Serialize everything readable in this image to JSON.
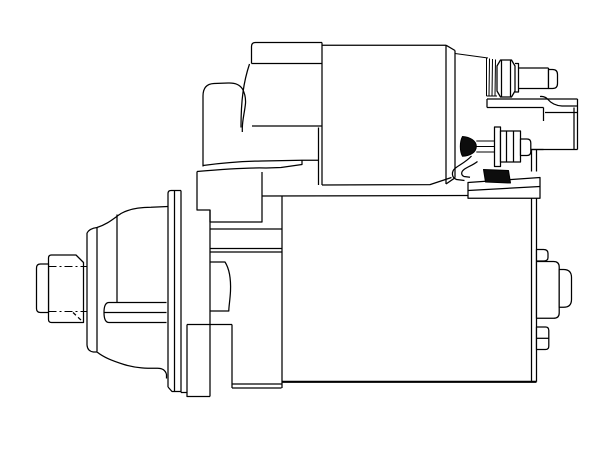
{
  "meta": {
    "description": "Technical side-view line drawing of an automotive starter motor with solenoid, terminal studs, mounting flange and splined drive shaft",
    "background_color": "#ffffff",
    "line_color": "#000000"
  },
  "illustration": {
    "width": 612,
    "height": 459,
    "viewBox": "0 0 612 459",
    "stroke": "#000000",
    "strokeWidth": 1.25,
    "shapes": [
      {
        "name": "spline-collar",
        "fill": "#ffffff",
        "d": "M51.5,255 L76,255 L83.5,262.5 L83.5,322.5 L51.5,322.5 Q48.5,322.5 48.5,319.5 L48.5,258 Q48.5,255 51.5,255 Z"
      },
      {
        "name": "spline-collar-chamfer-hidden",
        "dash": "4 3",
        "d": "M73,312.5 L83.5,322.5"
      },
      {
        "name": "spline-centerline-top",
        "dash": "8 3 2 3",
        "sw": 1.0,
        "d": "M48.5,266.5 L86.5,266.5"
      },
      {
        "name": "spline-centerline-bottom",
        "dash": "8 3 2 3",
        "sw": 1.0,
        "d": "M48.5,311.5 L86.5,311.5"
      },
      {
        "name": "drive-shaft-nose",
        "fill": "#ffffff",
        "d": "M48.5,264 L40.5,264 Q36.5,264 36.5,268 L36.5,308.5 Q36.5,312.5 40.5,312.5 L48.5,312.5 Z"
      },
      {
        "name": "drive-housing-top-contour",
        "d": "M87,233 Q89.5,228.5 97,227.5 C108,224 113.5,218.5 121,213.5 C129,209 139.5,207.3 151,207.3 L168,206.5"
      },
      {
        "name": "drive-housing-front-rim",
        "d": "M87,233 L87,345 M97,227.5 L97,351.5 M87,345 Q87.5,351.3 93.5,352 L97,352"
      },
      {
        "name": "drive-housing-bottom-contour",
        "d": "M97,352 C104,357.5 111.5,360.5 124,364.5 C137,368.5 149,368.3 157.5,368.3 C163,368.3 165.5,370.5 166.5,374.5 L166.5,378.5"
      },
      {
        "name": "drive-housing-step-line",
        "d": "M117,214.5 L117,302"
      },
      {
        "name": "drive-housing-slot",
        "d": "M166.5,302.5 L109,302.5 Q104,302.5 104,312.5 Q104,322.5 109,322.5 L166.5,322.5 M104.3,312.5 L166.5,312.5"
      },
      {
        "name": "mounting-flange",
        "d": "M168,387 L168,193.5 Q168,190.5 171,190.5 L181,190.5 M174.5,190.5 L174.5,391.5 M181,190.5 L181,392.5 M168,387 L172,391.5 L181,391.5 M181,392.5 L187,392.5"
      },
      {
        "name": "gear-housing-block",
        "d": "M197,171.5 L197,210 L210,210 L210,222 L262,222 L262,172"
      },
      {
        "name": "front-bracket-hump",
        "d": "M203,166.5 L203,96 Q203,84 214,83.5 L228,83 Q238.5,82.5 242.5,89 Q246,95.5 245.5,103.5 C244.5,113 242.5,119 242.3,128 L242.3,132"
      },
      {
        "name": "solenoid-hidden-edge-arc",
        "d": "M249.5,64 C243.5,82 241,100 241,127.5"
      },
      {
        "name": "bracket-edge-upper",
        "d": "M203,165.5 C225,162.5 245,161.2 262,161 L302,160.3 L318.5,160.3"
      },
      {
        "name": "bracket-edge-lower",
        "d": "M197,171.5 C225,169 249,167.5 266,168 L281,167.5 L302,164.5 L302,160.3"
      },
      {
        "name": "yoke-band-top",
        "d": "M210,229 L282,229"
      },
      {
        "name": "yoke-band-mid",
        "d": "M210,248.5 L282,248.5"
      },
      {
        "name": "yoke-band-bottom",
        "d": "M210,252 L282,252"
      },
      {
        "name": "yoke-left-edge",
        "d": "M210,210 L210,396.5"
      },
      {
        "name": "pinion-guide-block",
        "d": "M210,262 L225,262 C229.5,269 231,278 230.5,291 C230,301 228.8,306 228.8,311 L210,311"
      },
      {
        "name": "lower-cross-line",
        "d": "M187,324.5 L232,324.5"
      },
      {
        "name": "bottom-tab",
        "d": "M187,324.5 L187,396.5 L210,396.5"
      },
      {
        "name": "under-step",
        "d": "M232,324.5 L232,388 M232,384 L281.5,384 M232,388 L281.5,388"
      },
      {
        "name": "motor-yoke-left-edge",
        "d": "M282,195.5 L282,388"
      },
      {
        "name": "motor-yoke-top-edge",
        "d": "M262,196 L468,195.5"
      },
      {
        "name": "motor-yoke-bottom-edge",
        "sw": 2.2,
        "d": "M282,381.8 L536.5,381.8"
      },
      {
        "name": "motor-end-cap-rim",
        "d": "M531.5,198.5 L531.5,381.8 M536.5,198.5 L536.5,381.8 M531.5,150 L531.5,171.5 M536.5,150 L536.5,171.5 M529.5,149.5 L543.5,149.5"
      },
      {
        "name": "end-cap-upper-tab",
        "fill": "#ffffff",
        "d": "M536.5,261 L536.5,249.5 L543.5,249.5 Q548,249.5 548,253.5 L548,257.5 Q548,261 543.5,261 Z"
      },
      {
        "name": "end-cap-bearing-boss",
        "fill": "#ffffff",
        "d": "M536.5,318.3 L536.5,261.5 L553.5,261.5 Q559.2,261.5 559.2,267 L559.2,313 Q559.2,318.3 553.5,318.3 Z"
      },
      {
        "name": "end-cap-bearing-nose",
        "fill": "#ffffff",
        "d": "M559.2,269.5 L563.5,269.5 Q571.5,269.5 571.5,277.5 L571.5,299.5 Q571.5,307.3 563.5,307.3 L559.2,307.3 Z"
      },
      {
        "name": "end-cap-through-bolt",
        "fill": "#ffffff",
        "d": "M536.5,349.5 L536.5,327 L545.5,327 Q548.8,327 548.8,330.5 L548.8,346 Q548.8,349.5 545.5,349.5 Z"
      },
      {
        "name": "end-cap-through-bolt-line",
        "d": "M536.5,338.3 L548.8,338.3"
      },
      {
        "name": "solenoid-cap-block",
        "d": "M251.5,63.5 L251.5,46.5 Q251.5,42.5 255.5,42.5 L322,42.5 M251.5,63.5 L322,63.5 M252,126 L322,126"
      },
      {
        "name": "solenoid-left-edge-pair",
        "d": "M322,42.5 L322,185 M318.5,127.5 L318.5,185"
      },
      {
        "name": "solenoid-barrel",
        "d": "M322,45.2 L446,45.2 M322,185 L430,184.6 L451.5,177.5"
      },
      {
        "name": "solenoid-end-cap",
        "d": "M446,45.2 L446,184 M455,50.5 L455,177.8 M446,45.2 L455,50.5 M446,184 L455,177.8"
      },
      {
        "name": "serrated-washer-stack",
        "sw": 1.0,
        "d": "M455,53.5 L488,58 M486.5,58 L486.5,96 M489.5,58.5 L489,96 M492.5,59 L492,96 M495.5,59.5 L495,96 M486.5,96 L497,96"
      },
      {
        "name": "upper-terminal-hex-nut",
        "d": "M497,66 L500.5,60 L511.5,60 L515,66 L515,91 L511.5,97 L500.5,97 L497,91 Z M501.5,60 L501.5,97 M510.5,60 L510.5,97"
      },
      {
        "name": "upper-terminal-washer",
        "d": "M515,63.5 L518.5,63.5 L518.5,92 L515,92"
      },
      {
        "name": "battery-terminal-bolt-shank",
        "d": "M518.5,68 L548.5,68 M518.5,88.5 L548.5,88.5 M548.5,68 L548.5,88.5"
      },
      {
        "name": "battery-terminal-bolt-end",
        "fill": "#ffffff",
        "d": "M548.5,69.5 L552.5,69.5 Q557.5,69.5 557.5,74.5 L557.5,83.5 Q557.5,88.5 552.5,88.5 L548.5,88.5 Z"
      },
      {
        "name": "terminal-shelf",
        "d": "M487,99 L577.5,99 M487,107.5 L543.5,107.5 M487,99 L487,107.5"
      },
      {
        "name": "terminal-shelf-flap",
        "d": "M540,96.5 Q545,96 548,99.5 Q553,105.5 562,106 L577.5,106"
      },
      {
        "name": "terminal-block",
        "d": "M543.5,107.5 L543.5,121 M577.5,99 L577.5,149.5 M529.5,149.5 L577.5,149.5 M545,112.5 L577.5,112.5 M574,107.5 L574,149.5"
      },
      {
        "name": "bracket-foot",
        "fill": "#ffffff",
        "d": "M468,198.2 L468,182.5 L540,177.5 L540,198.2 Z"
      },
      {
        "name": "bracket-foot-line",
        "d": "M468,190.5 L540,186.5"
      },
      {
        "name": "cable-outer-curve",
        "d": "M471.5,156 C466,162 460,164.5 455.5,168 C451,171.5 451.5,177.5 456.5,179.5 L464.5,180.5"
      },
      {
        "name": "cable-inner-curve",
        "d": "M477.5,161.5 C472.5,165.5 468,166.5 464,169.5 C460.8,172 461,175 464,176.5 L470,177.3"
      },
      {
        "name": "rubber-boot",
        "fill": "#0d0d0d",
        "sw": 1.0,
        "d": "M483.5,169.5 L508.5,170.5 L510.5,183 L485.5,182 Z"
      },
      {
        "name": "field-terminal-stud",
        "fill": "#0d0d0d",
        "sw": 1.0,
        "d": "M462.5,136.5 C470,137.2 476.3,140.5 476.3,146.5 C476.3,152.5 470,155.8 462.5,156.3 C459.6,151 459.6,142 462.5,136.5 Z"
      },
      {
        "name": "field-terminal-shaft",
        "sw": 1.0,
        "d": "M476.3,141 L496.5,141 M476.3,152 L496.5,152 M476.3,146.5 L496.5,146.5"
      },
      {
        "name": "lower-terminal-washer",
        "fill": "#ffffff",
        "d": "M494.5,127 L500.5,127 L500.5,166.5 L494.5,166.5 Z"
      },
      {
        "name": "lower-terminal-hex-nut",
        "fill": "#ffffff",
        "d": "M500.5,131 L520.5,131 L520.5,162 L500.5,162 Z"
      },
      {
        "name": "lower-terminal-hex-facets",
        "d": "M506.5,131 L506.5,162 M513.5,131 L513.5,162"
      },
      {
        "name": "lower-terminal-end",
        "fill": "#ffffff",
        "d": "M520.5,139 L527,139 Q530.8,139 530.8,143 L530.8,151.5 Q530.8,155.5 527,155.5 L520.5,155.5 Z"
      }
    ]
  }
}
